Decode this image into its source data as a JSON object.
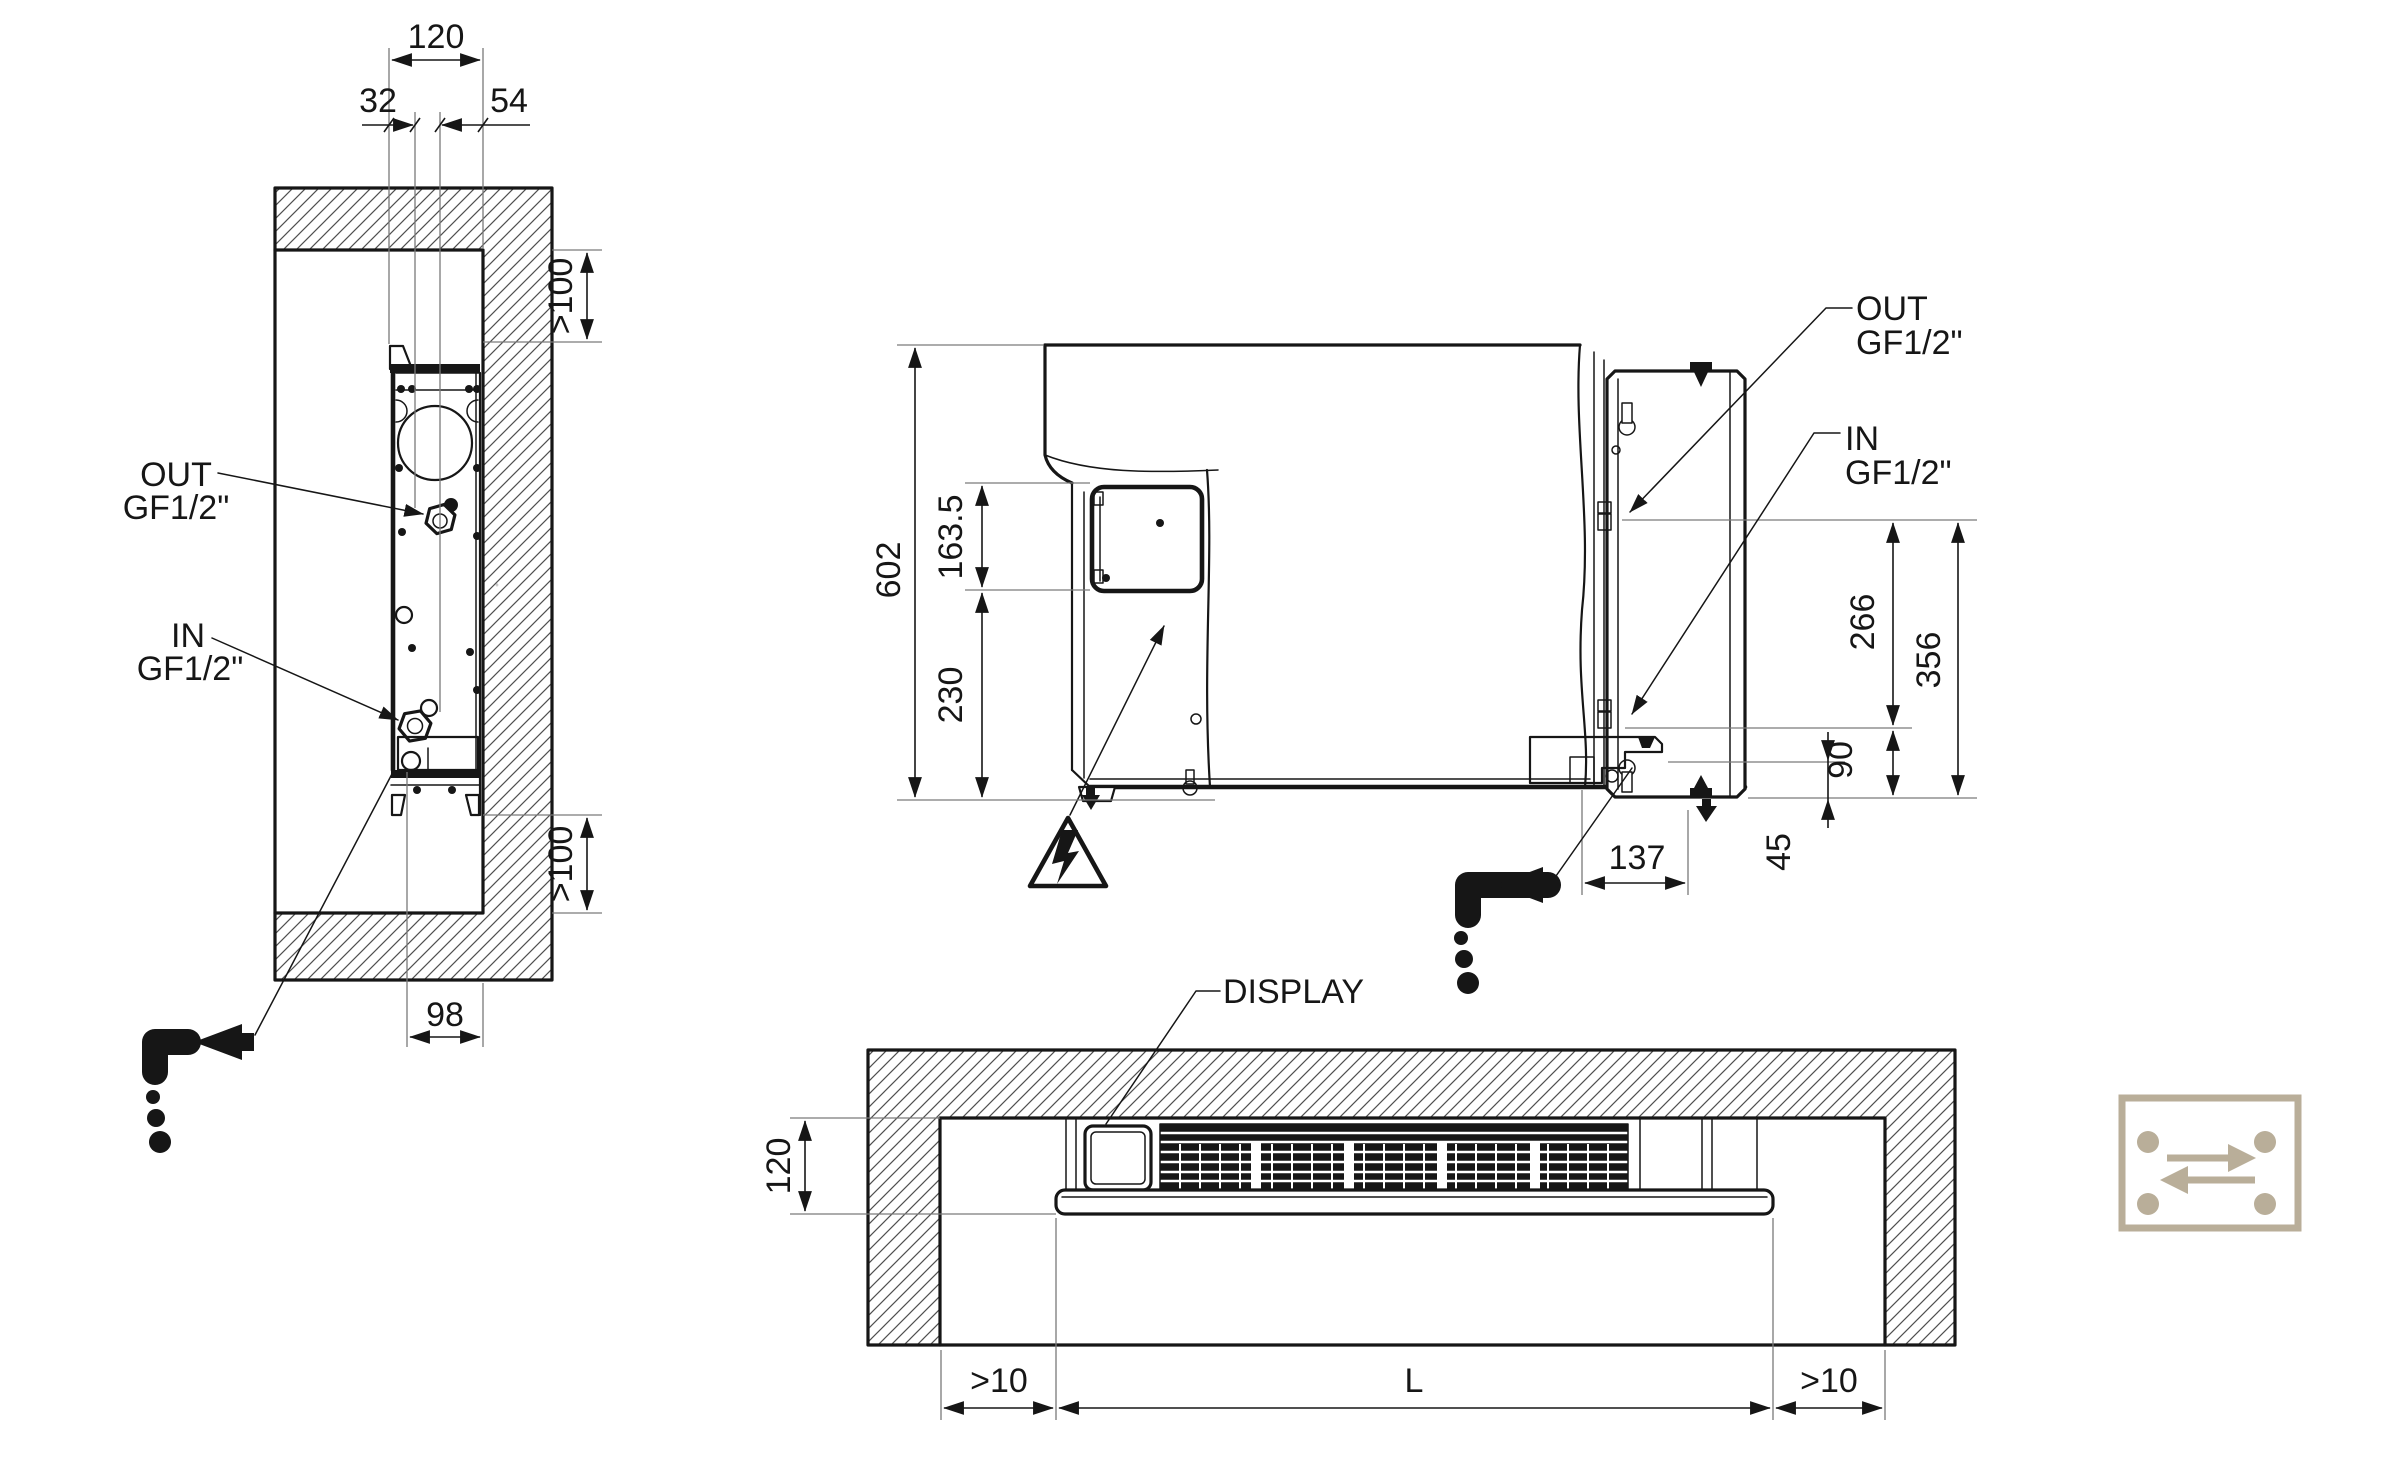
{
  "colors": {
    "line": "#161616",
    "ext": "#7a7a7a",
    "hatch": "#4f4f4f",
    "icon_accent": "#b9ae99"
  },
  "side_view": {
    "dims": {
      "depth": "120",
      "out_offset": "32",
      "in_offset": "54",
      "top_clearance": ">100",
      "bottom_clearance": ">100",
      "recess_depth": "98"
    },
    "out_port": {
      "name": "OUT",
      "thread": "GF1/2\""
    },
    "in_port": {
      "name": "IN",
      "thread": "GF1/2\""
    }
  },
  "front_view": {
    "dims": {
      "height": "602",
      "junction_box_height": "163.5",
      "junction_box_bottom": "230",
      "out_port_height": "266",
      "ports_span": "356",
      "in_port_height": "90",
      "drain_drop": "45",
      "drain_offset": "137"
    },
    "out_port": {
      "name": "OUT",
      "thread": "GF1/2\""
    },
    "in_port": {
      "name": "IN",
      "thread": "GF1/2\""
    }
  },
  "plan_view": {
    "dims": {
      "depth": "120",
      "left_clearance": ">10",
      "unit_length": "L",
      "right_clearance": ">10"
    },
    "display_label": "DISPLAY"
  },
  "icons": {
    "hazard": "electric-shock-warning",
    "condensate_left": "condensate-drain-direction",
    "condensate_front": "condensate-drain-direction",
    "reversible": "reversible-water-connections"
  }
}
